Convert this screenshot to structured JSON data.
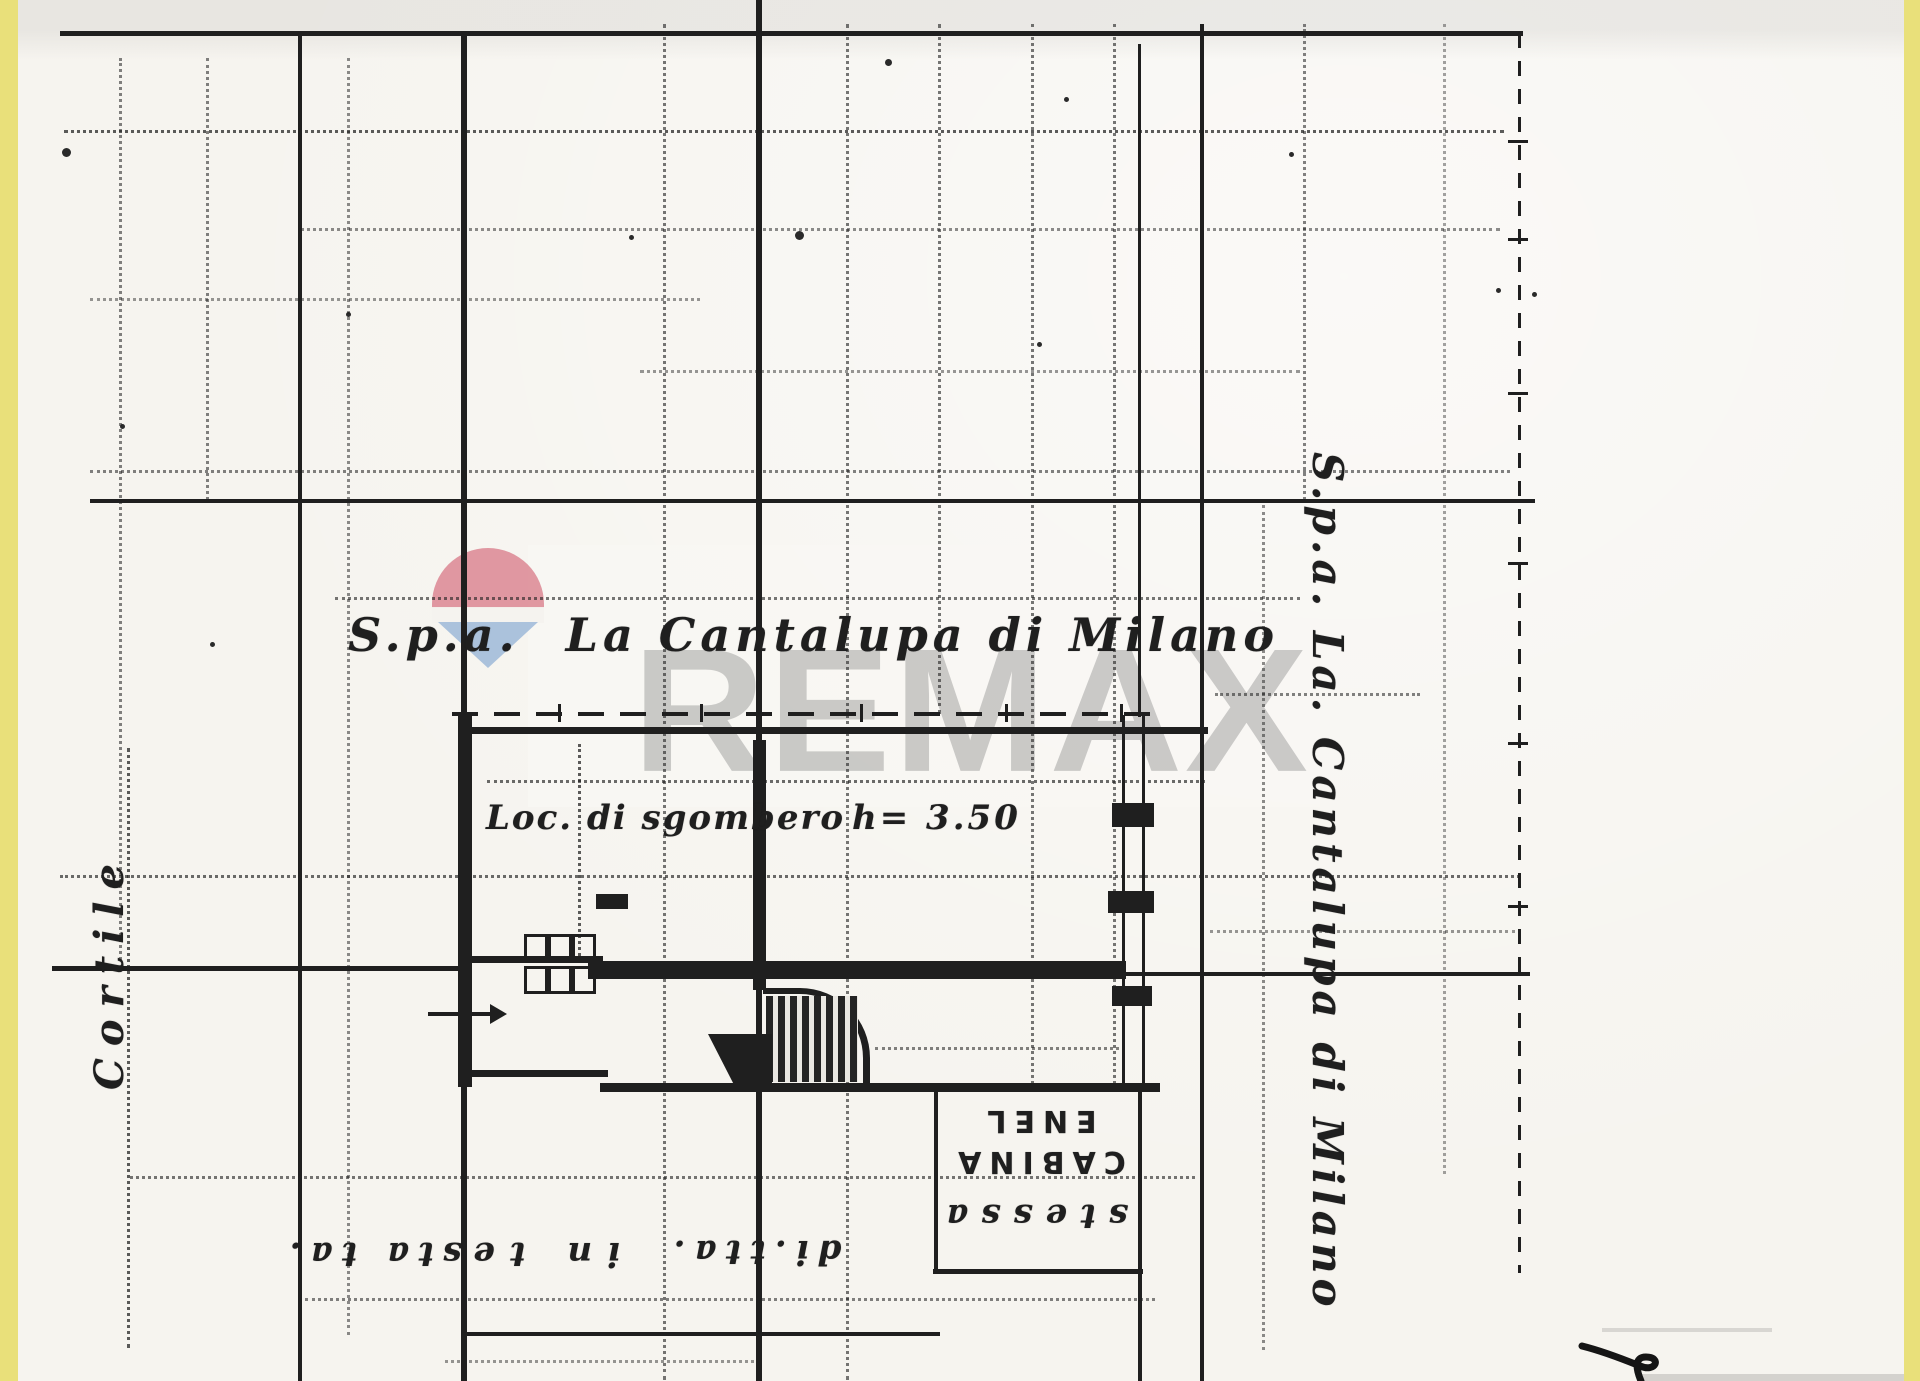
{
  "colors": {
    "paper": "#f6f4ef",
    "ink": "#1f1f1f",
    "edge_yellow": "#e9e07a",
    "watermark_gray": "rgba(145,145,145,0.45)",
    "balloon_red": "#dd8d98",
    "balloon_white": "#f4f2ee",
    "balloon_blue": "#9db9d8"
  },
  "watermark": {
    "text": "REMAX"
  },
  "labels": {
    "owner_prefix": "S.p.a.",
    "owner_name": "La Cantalupa di Milano",
    "owner_right_vertical": "S.p.a. La. Cantalupa di Milano",
    "courtyard": "Cortile",
    "storage_room": "Loc. di sgombero",
    "ceiling_height": "h= 3.50",
    "cabina_line1": "CABINA",
    "cabina_line2": "ENEL",
    "note_stessa": "stessa",
    "note_ditta": "di.tta.",
    "note_inte": "in te",
    "note_stata": "sta ta."
  }
}
